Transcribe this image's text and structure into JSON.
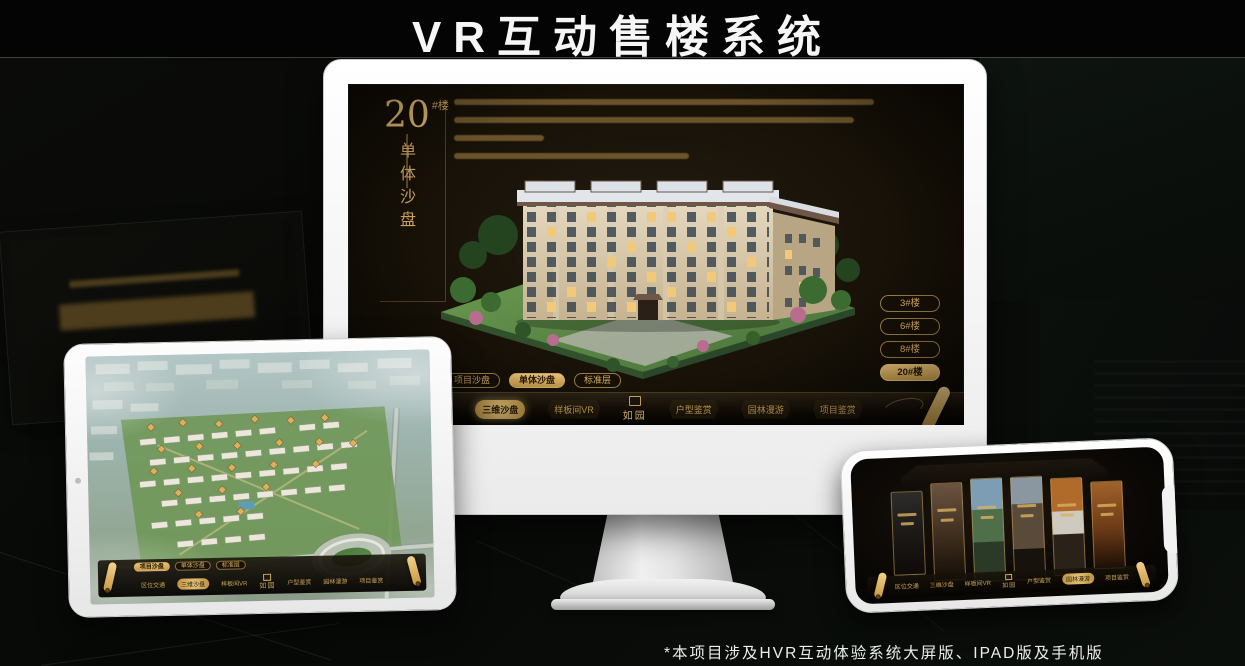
{
  "page": {
    "title": "VR互动售楼系统",
    "footnote": "*本项目涉及HVR互动体验系统大屏版、IPAD版及手机版"
  },
  "colors": {
    "gold": "#d2a85c",
    "gold_bright": "#e8c377",
    "screen_bg": "#16100a",
    "device_white": "#f7f7f7"
  },
  "monitor_ui": {
    "unit_number": "20",
    "unit_suffix": "#楼",
    "unit_subtitle": "单体沙盘",
    "floor_buttons": [
      "3#楼",
      "6#楼",
      "8#楼",
      "20#楼"
    ],
    "selected_floor": "20#楼",
    "sub_tabs": [
      "项目沙盘",
      "单体沙盘",
      "标准层"
    ],
    "selected_sub_tab": "单体沙盘",
    "nav": [
      "区位交通",
      "三维沙盘",
      "样板间VR",
      "户型鉴赏",
      "园林漫游",
      "项目鉴赏"
    ],
    "selected_nav": "三维沙盘",
    "logo": "如园"
  },
  "ipad_ui": {
    "sub_tabs": [
      "项目沙盘",
      "单体沙盘",
      "标准层"
    ],
    "selected_sub_tab": "项目沙盘",
    "nav": [
      "区位交通",
      "三维沙盘",
      "样板间VR",
      "户型鉴赏",
      "园林漫游",
      "项目鉴赏"
    ],
    "selected_nav": "三维沙盘",
    "logo": "如园"
  },
  "phone_ui": {
    "nav": [
      "区位交通",
      "三维沙盘",
      "样板间VR",
      "户型鉴赏",
      "园林漫游",
      "项目鉴赏"
    ],
    "selected_nav": "园林漫游",
    "logo": "如园"
  }
}
